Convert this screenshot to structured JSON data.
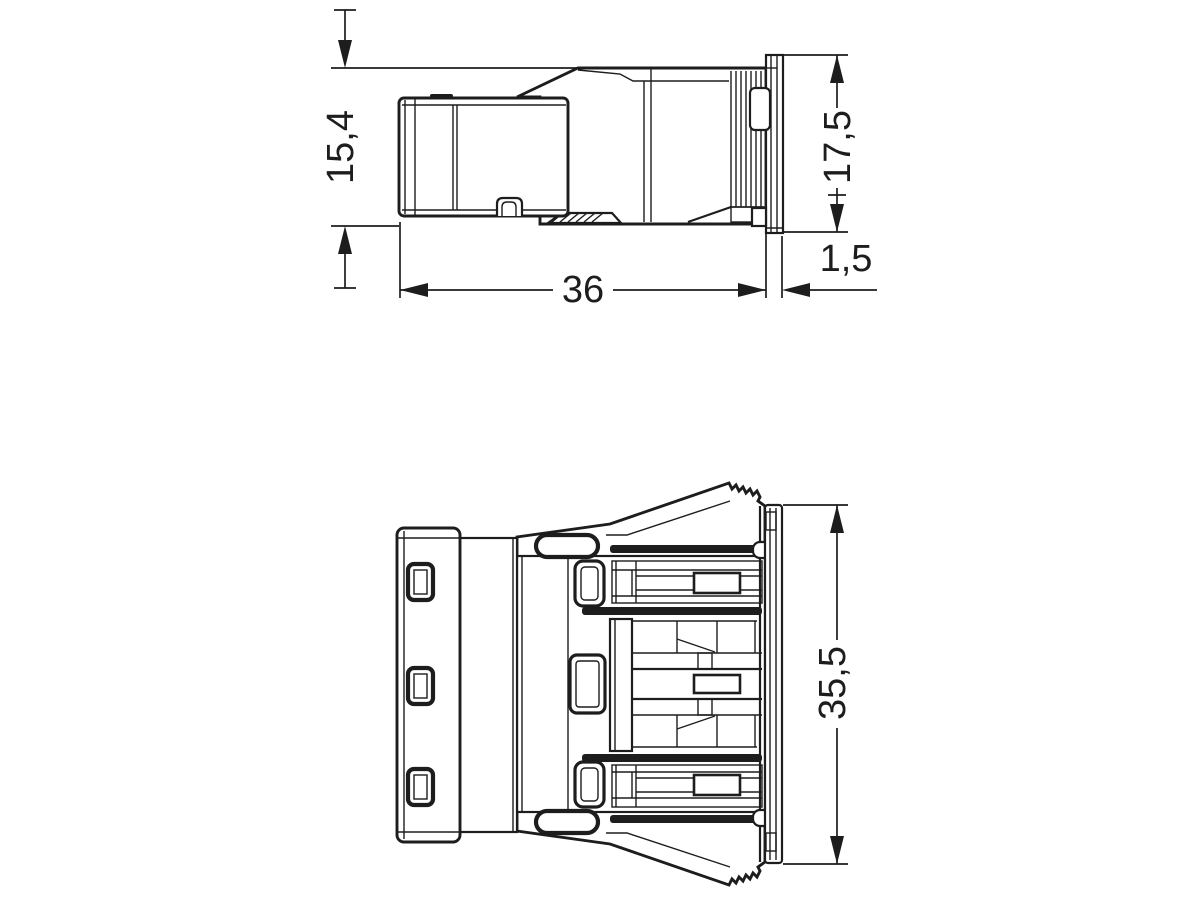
{
  "drawing": {
    "description": "Two-view technical dimension drawing of a snap-in panel-mount connector",
    "background": "#ffffff",
    "line_color": "#1d1d1d",
    "views": {
      "side_view": {
        "name": "side view",
        "dimensions": {
          "plug_height": "15,4",
          "panel_height": "17,5",
          "body_length": "36",
          "flange_thickness": "1,5"
        }
      },
      "front_view": {
        "name": "front view",
        "dimensions": {
          "overall_height": "35,5"
        }
      }
    }
  }
}
